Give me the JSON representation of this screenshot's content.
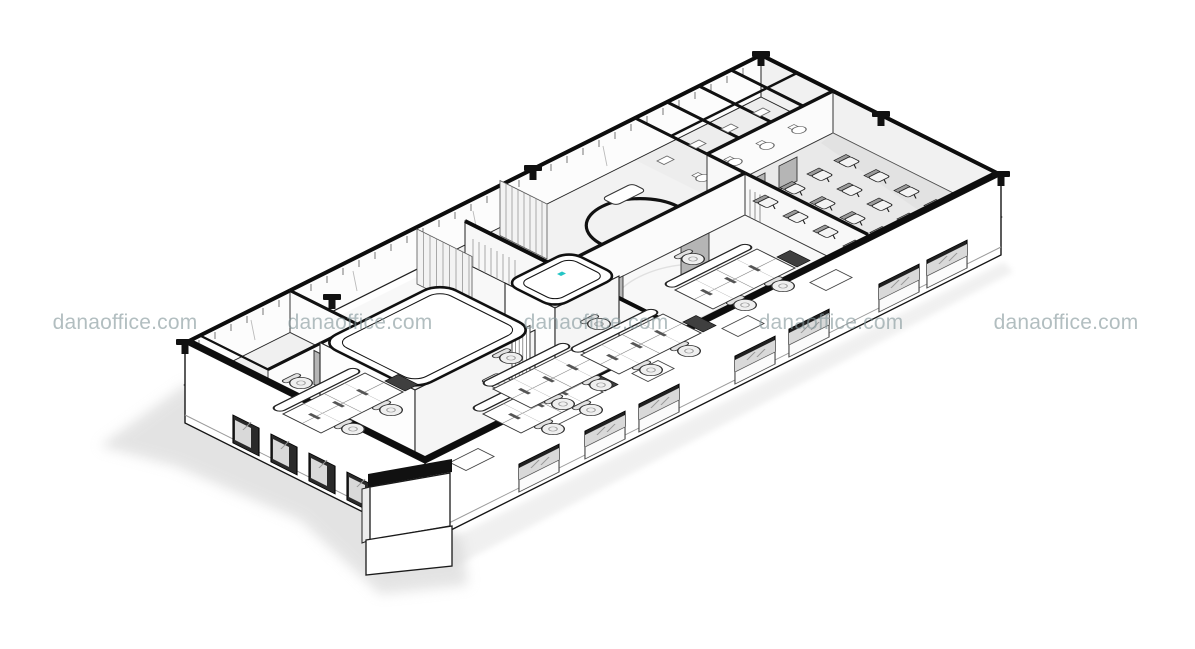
{
  "page": {
    "background": "#ffffff",
    "kind": "Axonometric cutaway drawing of an office floor plan"
  },
  "watermark": {
    "text": "danaoffice.com",
    "color": "#84979B",
    "instances": 5
  },
  "illustration": {
    "type": "architectural-axonometric-line-drawing",
    "line_color": "#1a1a1a",
    "wall_cut_color": "#0d0d0d",
    "floor_tint": "#f0f0f0",
    "door_color": "#b5b5b5",
    "window_frame_color": "#202020",
    "accent_marker_color": "#24c5c5",
    "shadow_color": "#c9c9c9",
    "areas": [
      "perimeter-glass-wall",
      "storage-room",
      "reception-pod",
      "phone-booth-pod",
      "open-plan-desks",
      "meeting-rooms",
      "corridor",
      "restroom-cubicles",
      "training-room",
      "entrance-core"
    ]
  }
}
